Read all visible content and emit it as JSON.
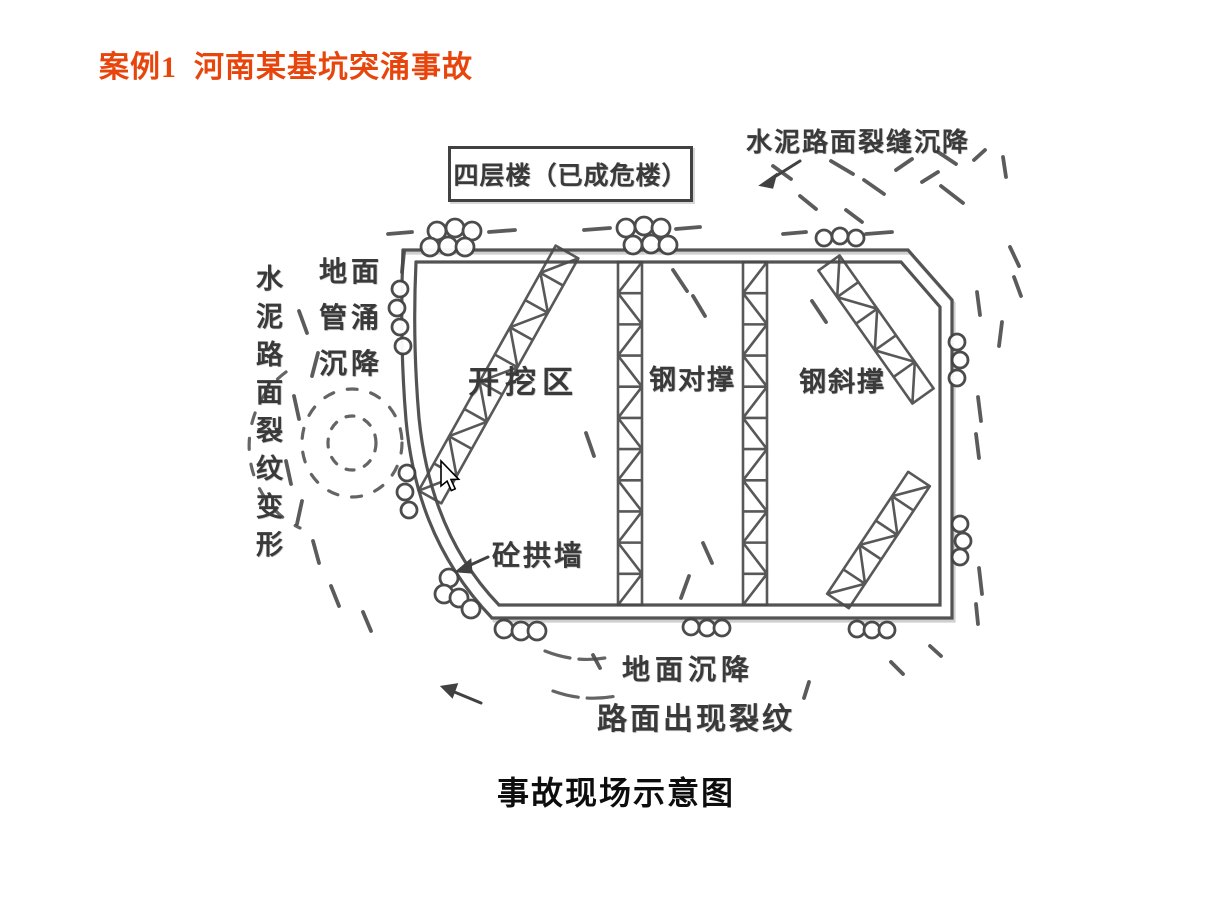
{
  "slide": {
    "title": "案例1  河南某基坑突涌事故",
    "caption": "事故现场示意图"
  },
  "diagram": {
    "building_label": "四层楼（已成危楼）",
    "label_top_right": "水泥路面裂缝沉降",
    "label_ground_piping": "地面管涌沉降",
    "label_left_vertical": "水泥路面裂纹变形",
    "label_excavation": "开挖区",
    "label_steel_cross_brace": "钢对撑",
    "label_steel_diagonal_brace": "钢斜撑",
    "label_concrete_arch_wall": "砼拱墙",
    "label_ground_settlement": "地面沉降",
    "label_road_cracks": "路面出现裂纹"
  },
  "colors": {
    "title": "#e8450d",
    "scan_ink": "#3f3f3f",
    "caption": "#0d0d0d",
    "background": "#ffffff"
  }
}
